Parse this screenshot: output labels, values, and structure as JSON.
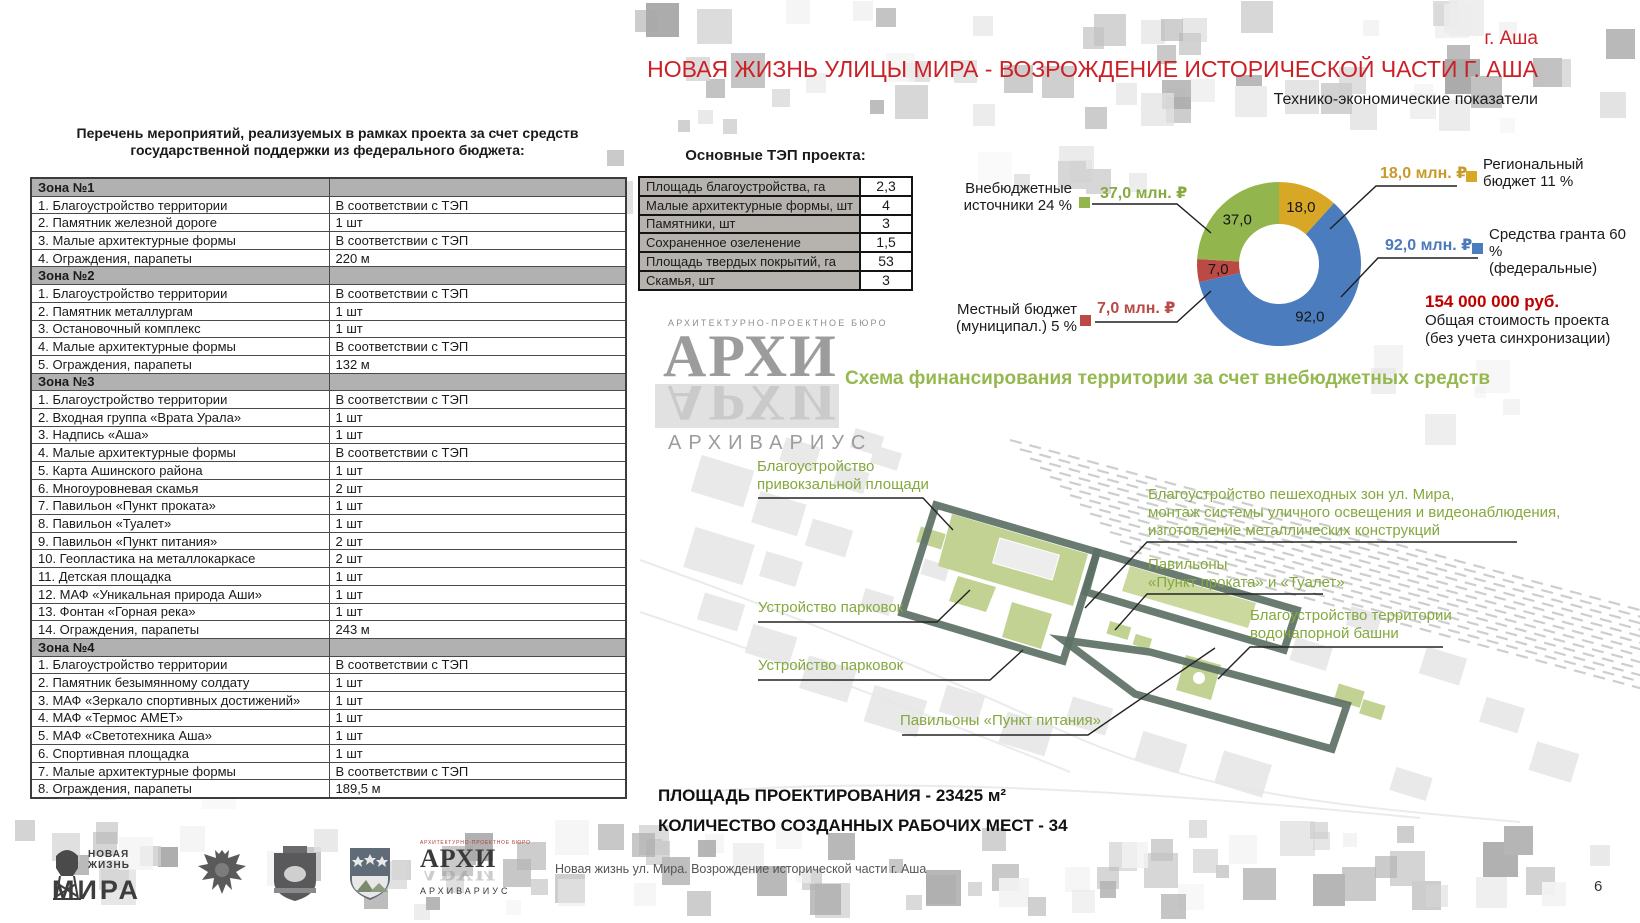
{
  "colors": {
    "accent_red": "#cb2026",
    "total_red": "#c00000",
    "annotation_green": "#85a83f",
    "scheme_title_green": "#95b84f",
    "boundary_green": "#5d7065",
    "patch_green": "#c2d292"
  },
  "header": {
    "city": "г. Аша",
    "title": "НОВАЯ ЖИЗНЬ УЛИЦЫ МИРА - ВОЗРОЖДЕНИЕ ИСТОРИЧЕСКОЙ ЧАСТИ Г. АША",
    "subtitle": "Технико-экономические показатели"
  },
  "events_table": {
    "title": "Перечень мероприятий, реализуемых в рамках проекта за счет средств государственной поддержки из федерального бюджета:",
    "zones": [
      {
        "name": "Зона №1",
        "rows": [
          [
            "1. Благоустройство территории",
            "В соответствии с ТЭП"
          ],
          [
            "2. Памятник железной дороге",
            "1 шт"
          ],
          [
            "3. Малые архитектурные формы",
            "В соответствии с ТЭП"
          ],
          [
            "4. Ограждения, парапеты",
            "220 м"
          ]
        ]
      },
      {
        "name": "Зона №2",
        "rows": [
          [
            "1. Благоустройство территории",
            "В соответствии с ТЭП"
          ],
          [
            "2. Памятник металлургам",
            "1 шт"
          ],
          [
            "3. Остановочный комплекс",
            "1 шт"
          ],
          [
            "4. Малые архитектурные формы",
            "В соответствии с ТЭП"
          ],
          [
            "5. Ограждения, парапеты",
            "132 м"
          ]
        ]
      },
      {
        "name": "Зона №3",
        "rows": [
          [
            "1. Благоустройство территории",
            "В соответствии с ТЭП"
          ],
          [
            "2. Входная группа «Врата Урала»",
            "1 шт"
          ],
          [
            "3. Надпись «Аша»",
            "1 шт"
          ],
          [
            "4. Малые архитектурные формы",
            "В соответствии с ТЭП"
          ],
          [
            "5. Карта Ашинского района",
            "1 шт"
          ],
          [
            "6. Многоуровневая скамья",
            "2 шт"
          ],
          [
            "7. Павильон «Пункт проката»",
            "1 шт"
          ],
          [
            "8. Павильон «Туалет»",
            "1 шт"
          ],
          [
            "9. Павильон «Пункт питания»",
            "2 шт"
          ],
          [
            "10. Геопластика на металлокаркасе",
            "2 шт"
          ],
          [
            "11. Детская площадка",
            "1 шт"
          ],
          [
            "12. МАФ «Уникальная природа Аши»",
            "1 шт"
          ],
          [
            "13. Фонтан «Горная река»",
            "1 шт"
          ],
          [
            "14. Ограждения, парапеты",
            "243 м"
          ]
        ]
      },
      {
        "name": "Зона №4",
        "rows": [
          [
            "1. Благоустройство территории",
            "В соответствии с ТЭП"
          ],
          [
            "2. Памятник безымянному солдату",
            "1 шт"
          ],
          [
            "3. МАФ «Зеркало спортивных достижений»",
            "1 шт"
          ],
          [
            "4. МАФ «Термос АМЕТ»",
            "1 шт"
          ],
          [
            "5. МАФ «Светотехника Аша»",
            "1 шт"
          ],
          [
            "6. Спортивная площадка",
            "1 шт"
          ],
          [
            "7. Малые архитектурные формы",
            "В соответствии с ТЭП"
          ],
          [
            "8. Ограждения, парапеты",
            "189,5 м"
          ]
        ]
      }
    ]
  },
  "tep_table": {
    "title": "Основные ТЭП проекта:",
    "rows": [
      [
        "Площадь благоустройства, га",
        "2,3"
      ],
      [
        "Малые архитектурные формы, шт",
        "4"
      ],
      [
        "Памятники, шт",
        "3"
      ],
      [
        "Сохраненное озеленение",
        "1,5"
      ],
      [
        "Площадь твердых покрытий, га",
        "53"
      ],
      [
        "Скамья, шт",
        "3"
      ]
    ]
  },
  "chart_data": {
    "type": "pie",
    "subtype": "donut",
    "units": "млн. ₽",
    "series": [
      {
        "name": "Региональный бюджет 11 %",
        "name_lines": [
          "Региональный",
          "бюджет 11 %"
        ],
        "value": 18.0,
        "label": "18,0",
        "amount": "18,0 млн. ₽",
        "percent": 11,
        "color": "#d9a726",
        "amount_color": "#c79b2a"
      },
      {
        "name": "Средства гранта 60 % (федеральные)",
        "name_lines": [
          "Средства гранта 60 %",
          "(федеральные)"
        ],
        "value": 92.0,
        "label": "92,0",
        "amount": "92,0 млн. ₽",
        "percent": 60,
        "color": "#4b7cbe",
        "amount_color": "#4b79bb"
      },
      {
        "name": "Местный бюджет (муниципал.) 5 %",
        "name_lines": [
          "Местный бюджет",
          "(муниципал.) 5 %"
        ],
        "value": 7.0,
        "label": "7,0",
        "amount": "7,0 млн. ₽",
        "percent": 5,
        "color": "#bb4a45",
        "amount_color": "#b94a45"
      },
      {
        "name": "Внебюджетные источники 24 %",
        "name_lines": [
          "Внебюджетные",
          "источники 24 %"
        ],
        "value": 37.0,
        "label": "37,0",
        "amount": "37,0 млн. ₽",
        "percent": 24,
        "color": "#93b54d",
        "amount_color": "#87aa3f"
      }
    ],
    "total": {
      "label": "154 000 000 руб.",
      "line1": "Общая стоимость проекта",
      "line2": "(без учета синхронизации)"
    }
  },
  "watermark": {
    "bureau": "АРХИТЕКТУРНО-ПРОЕКТНОЕ БЮРО",
    "word": "АРХИ",
    "name": "АРХИВАРИУС"
  },
  "scheme": {
    "title": "Схема финансирования территории за счет внебюджетных средств",
    "annotations": [
      {
        "text": "Благоустройство\nпривокзальной площади"
      },
      {
        "text": "Благоустройство пешеходных зон ул. Мира,\nмонтаж системы уличного освещения и видеонаблюдения,\nизготовление металлических конструкций"
      },
      {
        "text": "Павильоны\n«Пункт проката» и «Туалет»"
      },
      {
        "text": "Устройство парковок"
      },
      {
        "text": "Устройство парковок"
      },
      {
        "text": "Благоустройство территории\nводонапорной башни"
      },
      {
        "text": "Павильоны «Пункт питания»"
      }
    ],
    "area_line": "ПЛОЩАДЬ ПРОЕКТИРОВАНИЯ - 23425 м²",
    "jobs_line": "КОЛИЧЕСТВО СОЗДАННЫХ РАБОЧИХ МЕСТ - 34"
  },
  "footer": {
    "project_logo": {
      "word1": "НОВАЯ",
      "word2": "ЖИЗНЬ",
      "word3": "МИРА"
    },
    "archi_logo": {
      "bureau": "АРХИТЕКТУРНО-ПРОЕКТНОЕ БЮРО",
      "word": "АРХИ",
      "name": "АРХИВАРИУС"
    },
    "caption": "Новая жизнь ул. Мира. Возрождение исторической части г. Аша",
    "page_number": "6"
  }
}
